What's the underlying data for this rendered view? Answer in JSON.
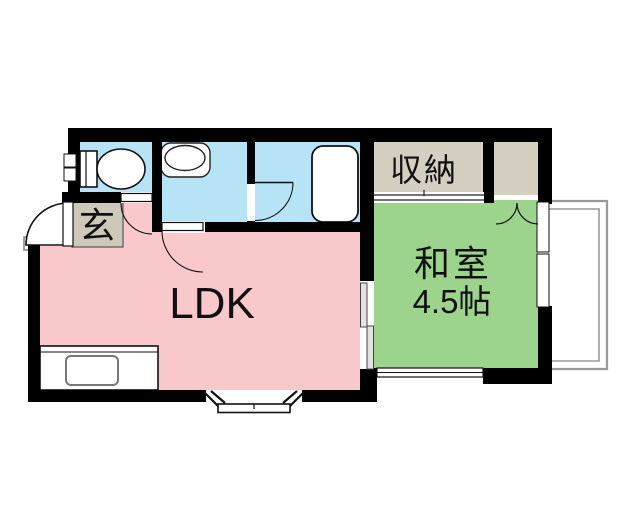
{
  "plan": {
    "type": "apartment-floor-plan",
    "rooms": {
      "ldk": {
        "label": "LDK",
        "color": "#f9c8cb"
      },
      "washitsu": {
        "label": "和室",
        "size": "4.5帖",
        "color": "#9cd48d"
      },
      "storage": {
        "label": "収納",
        "color": "#d5cfc2"
      },
      "side_closet": {
        "color": "#d5cfc2"
      },
      "genkan": {
        "label": "玄",
        "color": "#cec8b9"
      },
      "toilet_room": {
        "color": "#b6e3f6"
      },
      "washroom": {
        "color": "#b6e3f6"
      },
      "bathroom": {
        "color": "#b6e3f6"
      }
    },
    "colors": {
      "wall": "#000000",
      "balcony_line": "#9a9a9a",
      "fixture_fill": "#ffffff",
      "fixture_stroke": "#1a1a1a",
      "sliding_panel": "#e3e3e3"
    },
    "fixtures": [
      "toilet",
      "wash-basin",
      "bathtub",
      "kitchen-counter",
      "kitchen-sink"
    ],
    "openings": [
      "entrance-door",
      "toilet-door",
      "washroom-door",
      "bathroom-door",
      "closet-sliding-door",
      "washitsu-sliding-door",
      "double-closet-door",
      "bay-window",
      "balcony-window",
      "south-window",
      "toilet-window"
    ]
  }
}
